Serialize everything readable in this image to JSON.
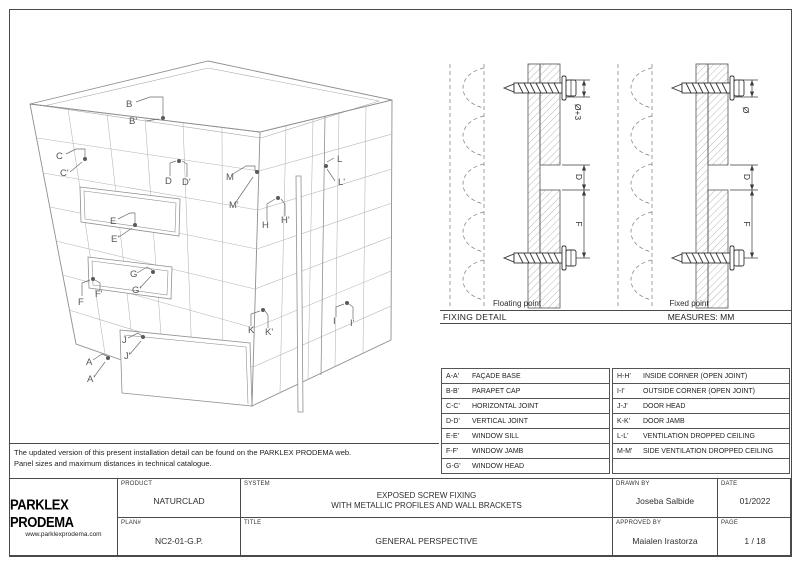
{
  "colors": {
    "border": "#4a4a4a",
    "drawing_line": "#9a9a9a",
    "detail_line": "#3c3c3c",
    "text": "#2e2e2e"
  },
  "notes": {
    "line1": "The updated version of this present installation detail can be found on the PARKLEX PRODEMA web.",
    "line2": "Panel sizes and maximum distances in technical catalogue."
  },
  "perspective": {
    "labels": [
      "B",
      "B'",
      "C",
      "C'",
      "D",
      "D'",
      "E",
      "E'",
      "F",
      "F'",
      "G",
      "G'",
      "H",
      "H'",
      "I",
      "I'",
      "J",
      "J'",
      "K",
      "K'",
      "L",
      "L'",
      "M",
      "M'",
      "A",
      "A'"
    ]
  },
  "fixing_detail": {
    "section_title": "FIXING DETAIL",
    "measures": "MEASURES: MM",
    "details": [
      {
        "caption": "Floating point",
        "dims": [
          "Ø+3",
          "D",
          "F"
        ]
      },
      {
        "caption": "Fixed point",
        "dims": [
          "Ø",
          "D",
          "F"
        ]
      }
    ]
  },
  "legend": {
    "left": [
      {
        "code": "A-A'",
        "desc": "FAÇADE BASE"
      },
      {
        "code": "B-B'",
        "desc": "PARAPET CAP"
      },
      {
        "code": "C-C'",
        "desc": "HORIZONTAL JOINT"
      },
      {
        "code": "D-D'",
        "desc": "VERTICAL JOINT"
      },
      {
        "code": "E-E'",
        "desc": "WINDOW SILL"
      },
      {
        "code": "F-F'",
        "desc": "WINDOW JAMB"
      },
      {
        "code": "G-G'",
        "desc": "WINDOW HEAD"
      }
    ],
    "right": [
      {
        "code": "H-H'",
        "desc": "INSIDE CORNER (OPEN JOINT)"
      },
      {
        "code": "I-I'",
        "desc": "OUTSIDE CORNER (OPEN JOINT)"
      },
      {
        "code": "J-J'",
        "desc": "DOOR HEAD"
      },
      {
        "code": "K-K'",
        "desc": "DOOR JAMB"
      },
      {
        "code": "L-L'",
        "desc": "VENTILATION DROPPED CEILING"
      },
      {
        "code": "M-M'",
        "desc": "SIDE VENTILATION DROPPED CEILING"
      },
      {
        "code": "",
        "desc": ""
      }
    ]
  },
  "title_block": {
    "logo": {
      "name": "PARKLEX PRODEMA",
      "url": "www.parklexprodema.com"
    },
    "product": {
      "label": "PRODUCT",
      "value": "NATURCLAD"
    },
    "system": {
      "label": "SYSTEM",
      "value_line1": "EXPOSED SCREW FIXING",
      "value_line2": "WITH METALLIC PROFILES AND WALL BRACKETS"
    },
    "plan": {
      "label": "PLAN#",
      "value": "NC2-01-G.P."
    },
    "title": {
      "label": "TITLE",
      "value": "GENERAL PERSPECTIVE"
    },
    "drawn_by": {
      "label": "DRAWN BY",
      "value": "Joseba Salbide"
    },
    "date": {
      "label": "DATE",
      "value": "01/2022"
    },
    "approved_by": {
      "label": "APPROVED BY",
      "value": "Maialen Irastorza"
    },
    "page": {
      "label": "PAGE",
      "value": "1 / 18"
    }
  }
}
